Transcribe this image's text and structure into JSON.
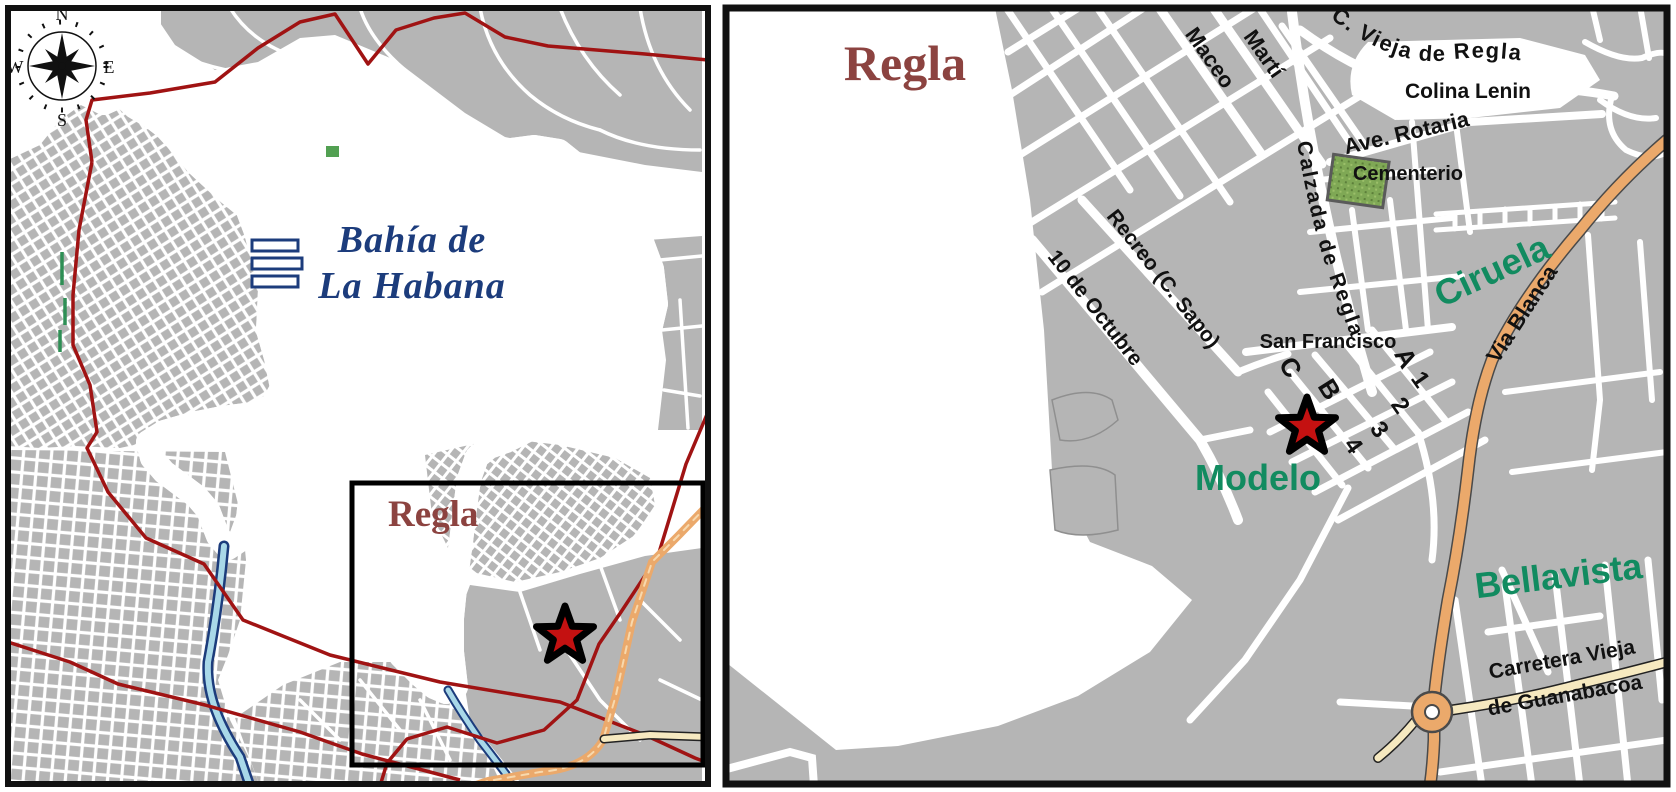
{
  "left_panel": {
    "compass": {
      "north": "N",
      "east": "E",
      "south": "S",
      "west": "W"
    },
    "water_label": {
      "line1": "Bahía de",
      "line2": "La Habana"
    },
    "inset_label": "Regla"
  },
  "right_panel": {
    "title": "Regla",
    "streets": {
      "maceo": "Maceo",
      "marti": "Martí",
      "c_vieja": "C. Vieja  de Regla",
      "ave_rotaria": "Ave. Rotaria",
      "calzada": "Calzada  de Regla",
      "via_blanca": "Via Blanca",
      "recreo": "Recreo (C. Sapo)",
      "octubre": "10 de Octubre",
      "san_francisco": "San Francisco",
      "street_a": "A",
      "street_b": "B",
      "street_c": "C",
      "street_1": "1",
      "street_2": "2",
      "street_3": "3",
      "street_4": "4",
      "carretera_line1": "Carretera Vieja",
      "carretera_line2": "de Guanabacoa"
    },
    "districts": {
      "colina_lenin": "Colina Lenin",
      "ciruela": "Ciruela",
      "modelo": "Modelo",
      "bellavista": "Bellavista"
    },
    "places": {
      "cementerio": "Cementerio"
    }
  },
  "colors": {
    "water": "#a9d8e8",
    "coastline": "#1c3c7c",
    "urban_gray": "#b5b5b5",
    "boundary_red": "#a01313",
    "star_red": "#c41111",
    "title_maroon": "#8c4340",
    "district_green": "#128b60",
    "road_orange": "#eba96b",
    "road_cream": "#f6e9c0",
    "cemetery_green": "#7fa855"
  }
}
